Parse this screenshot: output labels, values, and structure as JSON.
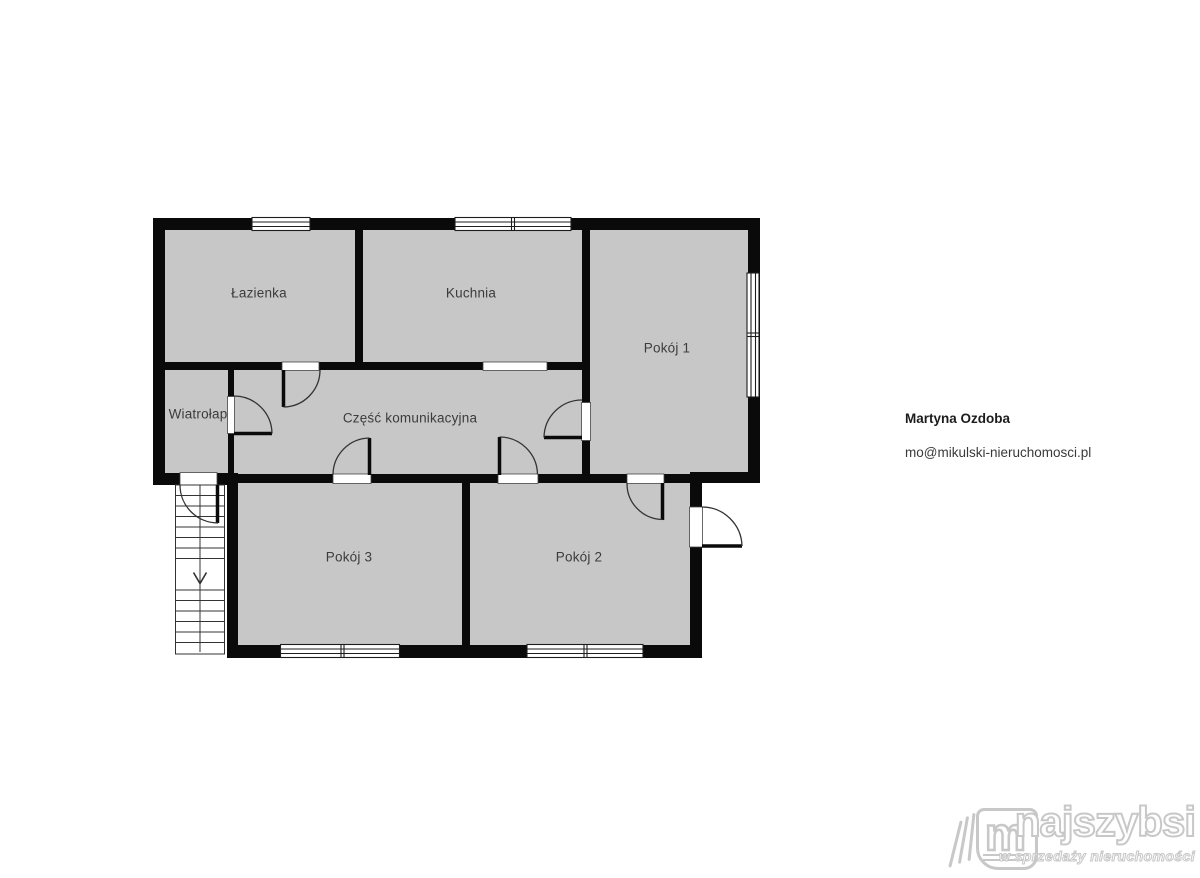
{
  "plan": {
    "rooms": {
      "lazienka": {
        "label": "Łazienka"
      },
      "kuchnia": {
        "label": "Kuchnia"
      },
      "pokoj1": {
        "label": "Pokój 1"
      },
      "wiatrolap": {
        "label": "Wiatrołap"
      },
      "czesc_komunikacyjna": {
        "label": "Część komunikacyjna"
      },
      "pokoj3": {
        "label": "Pokój 3"
      },
      "pokoj2": {
        "label": "Pokój 2"
      }
    },
    "colors": {
      "floor": "#c7c7c7",
      "wall": "#0a0a0a",
      "line": "#333333"
    }
  },
  "agent": {
    "name": "Martyna Ozdoba",
    "email": "mo@mikulski-nieruchomosci.pl"
  },
  "logo": {
    "icon_letter": "m",
    "brand": "najszybsi",
    "tagline": "w sprzedaży nieruchomości"
  }
}
